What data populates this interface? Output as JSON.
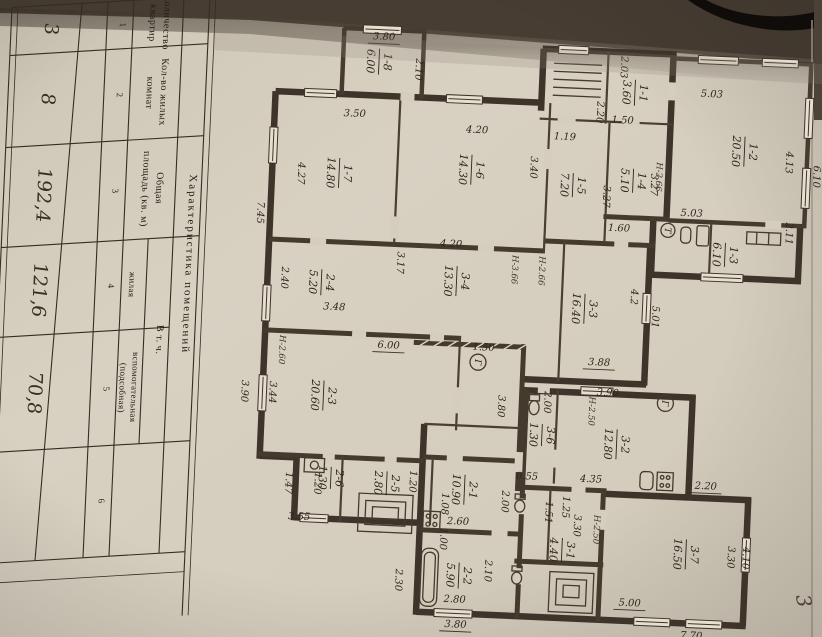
{
  "document": {
    "kind": "scanned floor plan sheet",
    "page_number": "3"
  },
  "colors": {
    "paper": "#d6cfc0",
    "paper_dark": "#c9c1b0",
    "ink": "#2e261d",
    "wall": "#3e342a",
    "background": "#1f1a15"
  },
  "table": {
    "title": "Характеристика помещений",
    "group_header": "В т. ч.",
    "rows": [
      {
        "h1": "Количество",
        "h2": "квартир",
        "num": "1",
        "value": "3"
      },
      {
        "h1": "Кол-во жилых",
        "h2": "комнат",
        "num": "2",
        "value": "8"
      },
      {
        "h1": "Общая",
        "h2": "площадь (кв. м)",
        "num": "3",
        "value": "192,4"
      },
      {
        "h1": "жилая",
        "h2": "",
        "num": "4",
        "value": "121,6"
      },
      {
        "h1": "вспомогательная",
        "h2": "(подсобная)",
        "num": "5",
        "value": "70,8"
      },
      {
        "h1": "",
        "h2": "",
        "num": "6",
        "value": ""
      }
    ]
  },
  "plan": {
    "rooms": [
      {
        "num": "1-1",
        "area": "3.60"
      },
      {
        "num": "1-2",
        "area": "20.50"
      },
      {
        "num": "1-3",
        "area": "6.10"
      },
      {
        "num": "1-4",
        "area": "5.10"
      },
      {
        "num": "1-5",
        "area": "7.20"
      },
      {
        "num": "1-6",
        "area": "14.30"
      },
      {
        "num": "1-7",
        "area": "14.80"
      },
      {
        "num": "1-8",
        "area": "6.00"
      },
      {
        "num": "2-1",
        "area": "10.90"
      },
      {
        "num": "2-2",
        "area": "5.90"
      },
      {
        "num": "2-3",
        "area": "20.60"
      },
      {
        "num": "2-4",
        "area": "5.20"
      },
      {
        "num": "2-5",
        "area": "2.80"
      },
      {
        "num": "2-6",
        "area": "1.30"
      },
      {
        "num": "3-1",
        "area": "4.40"
      },
      {
        "num": "3-2",
        "area": "12.80"
      },
      {
        "num": "3-3",
        "area": "16.40"
      },
      {
        "num": "3-4",
        "area": "13.30"
      },
      {
        "num": "3-6",
        "area": "1.30"
      },
      {
        "num": "3-7",
        "area": "16.50"
      }
    ],
    "dims": [
      {
        "t": "3.80"
      },
      {
        "t": "2.10"
      },
      {
        "t": "3.50"
      },
      {
        "t": "4.20"
      },
      {
        "t": "4.27"
      },
      {
        "t": "7.45"
      },
      {
        "t": "3.40"
      },
      {
        "t": "2.03"
      },
      {
        "t": "2.20"
      },
      {
        "t": "1.50"
      },
      {
        "t": "1.19"
      },
      {
        "t": "3.27"
      },
      {
        "t": "3.27"
      },
      {
        "t": "5.03"
      },
      {
        "t": "4.13"
      },
      {
        "t": "6.10"
      },
      {
        "t": "5.03"
      },
      {
        "t": "2.11"
      },
      {
        "t": "1.60"
      },
      {
        "t": "2.40"
      },
      {
        "t": "3.17"
      },
      {
        "t": "3.48"
      },
      {
        "t": "4.20"
      },
      {
        "t": "4.2"
      },
      {
        "t": "5.01"
      },
      {
        "t": "3.88"
      },
      {
        "t": "6.00"
      },
      {
        "t": "3.44"
      },
      {
        "t": "3.90"
      },
      {
        "t": "1.50"
      },
      {
        "t": "3.80"
      },
      {
        "t": "3.90"
      },
      {
        "t": "2.00"
      },
      {
        "t": "0.55"
      },
      {
        "t": "4.35"
      },
      {
        "t": "1.47"
      },
      {
        "t": "3.55"
      },
      {
        "t": "1.20"
      },
      {
        "t": "1.20"
      },
      {
        "t": "2.00"
      },
      {
        "t": "2.60"
      },
      {
        "t": "2.10"
      },
      {
        "t": "2.80"
      },
      {
        "t": "2.30"
      },
      {
        "t": "3.80"
      },
      {
        "t": "1.51"
      },
      {
        "t": "1.25"
      },
      {
        "t": "3.30"
      },
      {
        "t": "2.20"
      },
      {
        "t": "3.30"
      },
      {
        "t": "4.10"
      },
      {
        "t": "5.00"
      },
      {
        "t": "7.70"
      },
      {
        "t": "1.08"
      },
      {
        "t": "1.00"
      }
    ],
    "heights": [
      {
        "t": "Н-2.60"
      },
      {
        "t": "Н-3.66"
      },
      {
        "t": "Н-2.66"
      },
      {
        "t": "Н-2.50"
      },
      {
        "t": "Н-2.50"
      },
      {
        "t": "Н-2.66"
      }
    ],
    "meters": [
      {
        "t": "Г"
      },
      {
        "t": "Г"
      },
      {
        "t": "Т"
      }
    ]
  }
}
